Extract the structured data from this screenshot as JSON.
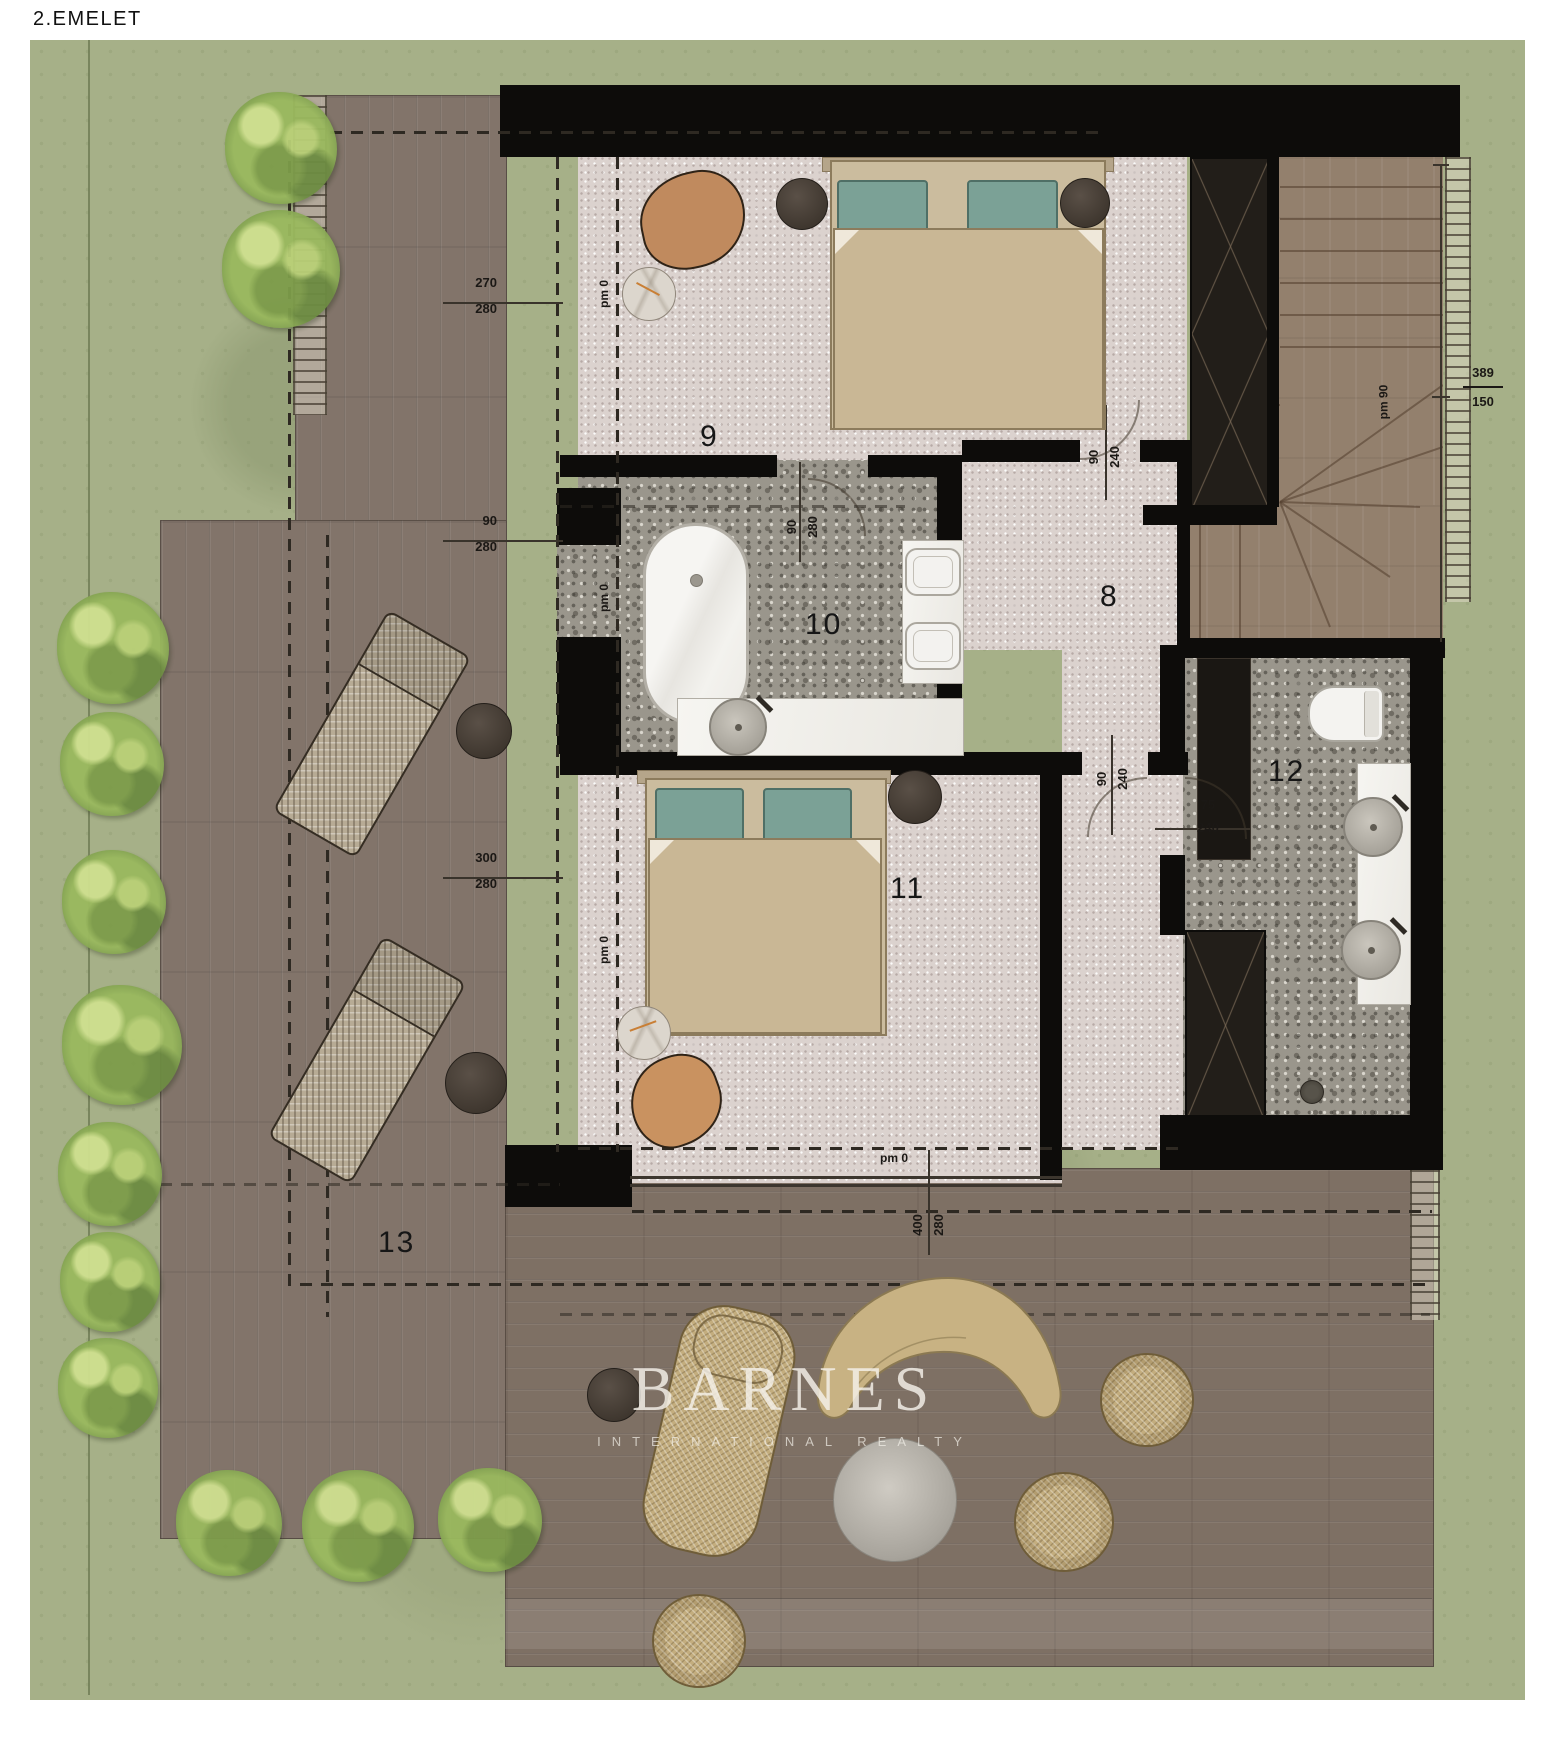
{
  "title": "2.EMELET",
  "watermark": {
    "brand": "BARNES",
    "tagline": "INTERNATIONAL REALTY"
  },
  "room_labels": {
    "r8": "8",
    "r9": "9",
    "r10": "10",
    "r11": "11",
    "r12": "12",
    "r13": "13"
  },
  "pm_labels": {
    "pm0": "pm 0",
    "pm90": "pm 90"
  },
  "dims": {
    "d270_280": {
      "a": "270",
      "b": "280"
    },
    "d90_280_left": {
      "a": "90",
      "b": "280"
    },
    "d300_280": {
      "a": "300",
      "b": "280"
    },
    "d90_280_door": {
      "a": "90",
      "b": "280"
    },
    "d90_240_top": {
      "a": "90",
      "b": "240"
    },
    "d90_240_mid": {
      "a": "90",
      "b": "240"
    },
    "d75_240": {
      "a": "75",
      "b": "240"
    },
    "d400_280": {
      "a": "400",
      "b": "280"
    },
    "d389_150": {
      "a": "389",
      "b": "150"
    }
  },
  "palette": {
    "grass": "#a6b088",
    "deck": "#7e7064",
    "wall": "#0d0c0a",
    "bedroom_floor": "#dbd2ce",
    "bath_floor": "#9a968c",
    "pillow_teal": "#7ba196",
    "blanket": "#c9b795",
    "wicker": "#c3ad7e"
  }
}
